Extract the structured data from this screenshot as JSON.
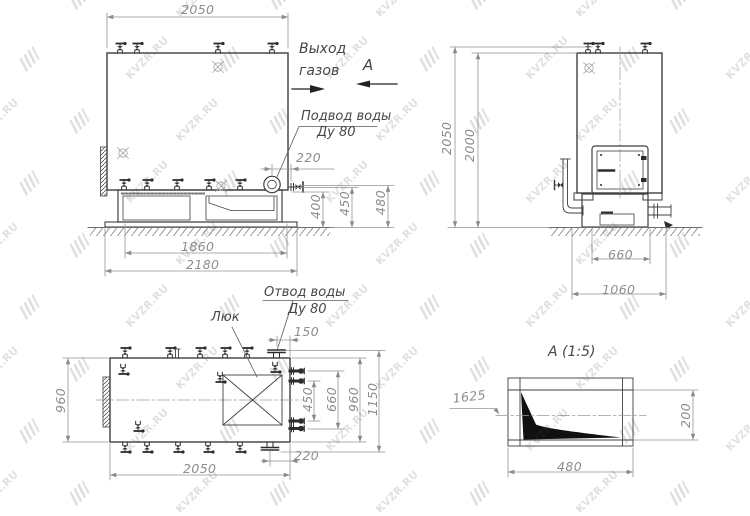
{
  "watermark": {
    "text": "KVZR.RU"
  },
  "front_view": {
    "labels": {
      "gas_outlet_line1": "Выход",
      "gas_outlet_line2": "газов",
      "section_letter": "А",
      "water_supply_line1": "Подвод воды",
      "water_supply_line2": "Ду 80"
    },
    "dims": {
      "overall_width": "2050",
      "supply_offset": "220",
      "height_400": "400",
      "height_450": "450",
      "height_480": "480",
      "base_inner": "1860",
      "base_outer": "2180"
    }
  },
  "side_view": {
    "dims": {
      "overall_height": "2050",
      "shell_height": "2000",
      "base_width": "660",
      "base_overall": "1060"
    }
  },
  "top_view": {
    "labels": {
      "water_drain_line1": "Отвод воды",
      "water_drain_line2": "Ду 80",
      "hatch": "Люк"
    },
    "dims": {
      "drain_offset_top": "150",
      "body_width_left": "960",
      "nozzle_span_450": "450",
      "nozzle_span_660": "660",
      "body_width_right": "960",
      "overall_width": "1150",
      "drain_offset_bottom": "220",
      "body_length": "2050"
    }
  },
  "section_view": {
    "title": "А (1:5)",
    "dims": {
      "elevation": "1625",
      "height": "200",
      "width": "480"
    }
  }
}
